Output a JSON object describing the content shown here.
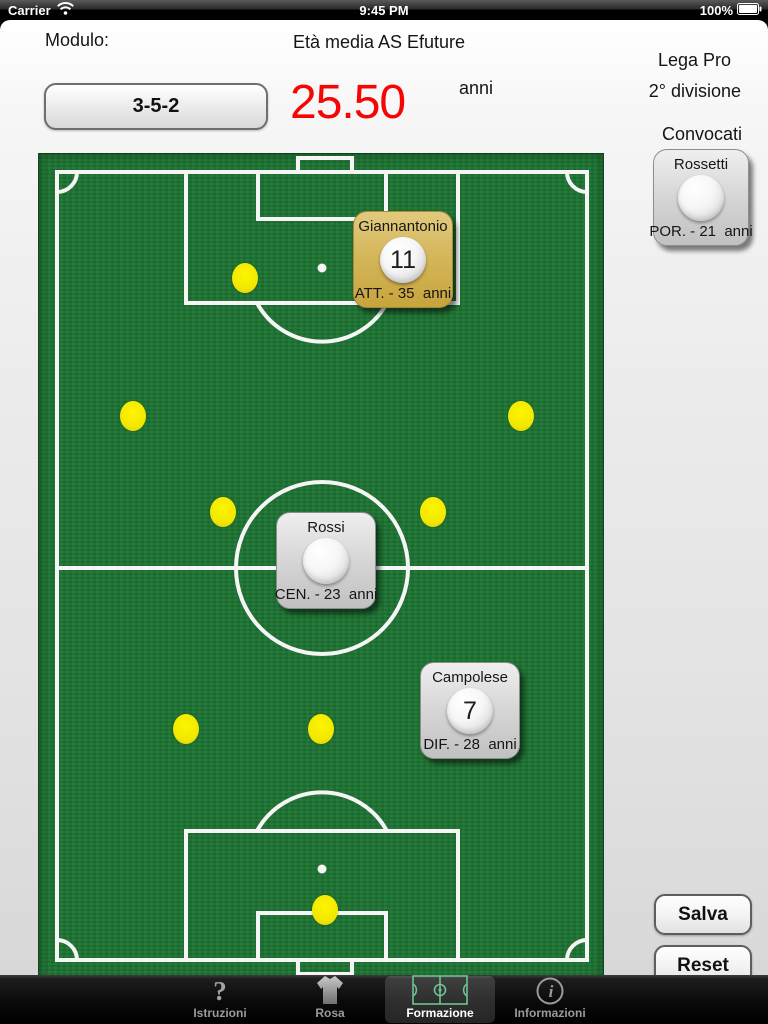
{
  "status_bar": {
    "carrier": "Carrier",
    "time": "9:45 PM",
    "battery": "100%"
  },
  "header": {
    "modulo_label": "Modulo:",
    "formation": "3-5-2",
    "eta_media_label": "Età media",
    "team_name": "AS Efuture",
    "average_age": "25.50",
    "age_unit": "anni",
    "league": "Lega Pro",
    "division": "2° divisione",
    "convocati_label": "Convocati"
  },
  "convocati": {
    "cards": [
      {
        "name": "Rossetti",
        "number": "",
        "info": "POR. - 21  anni",
        "color": "gray"
      }
    ]
  },
  "field": {
    "placed_cards": [
      {
        "name": "Giannantonio",
        "number": "11",
        "info": "ATT. - 35  anni",
        "color": "gold",
        "x": 353,
        "y": 211
      },
      {
        "name": "Rossi",
        "number": "",
        "info": "CEN. - 23  anni",
        "color": "gray",
        "x": 276,
        "y": 512
      },
      {
        "name": "Campolese",
        "number": "7",
        "info": "DIF. - 28  anni",
        "color": "gray",
        "x": 420,
        "y": 662
      }
    ],
    "dots": [
      [
        244,
        257
      ],
      [
        132,
        395
      ],
      [
        520,
        395
      ],
      [
        222,
        491
      ],
      [
        432,
        491
      ],
      [
        185,
        708
      ],
      [
        320,
        708
      ],
      [
        324,
        889
      ]
    ]
  },
  "actions": {
    "save": "Salva",
    "reset": "Reset"
  },
  "tab_bar": {
    "tabs": [
      {
        "label": "Istruzioni",
        "icon": "question-icon",
        "selected": false
      },
      {
        "label": "Rosa",
        "icon": "shirt-icon",
        "selected": false
      },
      {
        "label": "Formazione",
        "icon": "pitch-icon",
        "selected": true
      },
      {
        "label": "Informazioni",
        "icon": "info-icon",
        "selected": false
      }
    ]
  },
  "colors": {
    "pitch_green": "#1e7433",
    "dot_yellow": "#f2e800",
    "card_gold": "#d5b75c",
    "card_gray": "#d8d8d8",
    "age_red": "#f60505",
    "tab_icon_green": "#6fc28e"
  }
}
